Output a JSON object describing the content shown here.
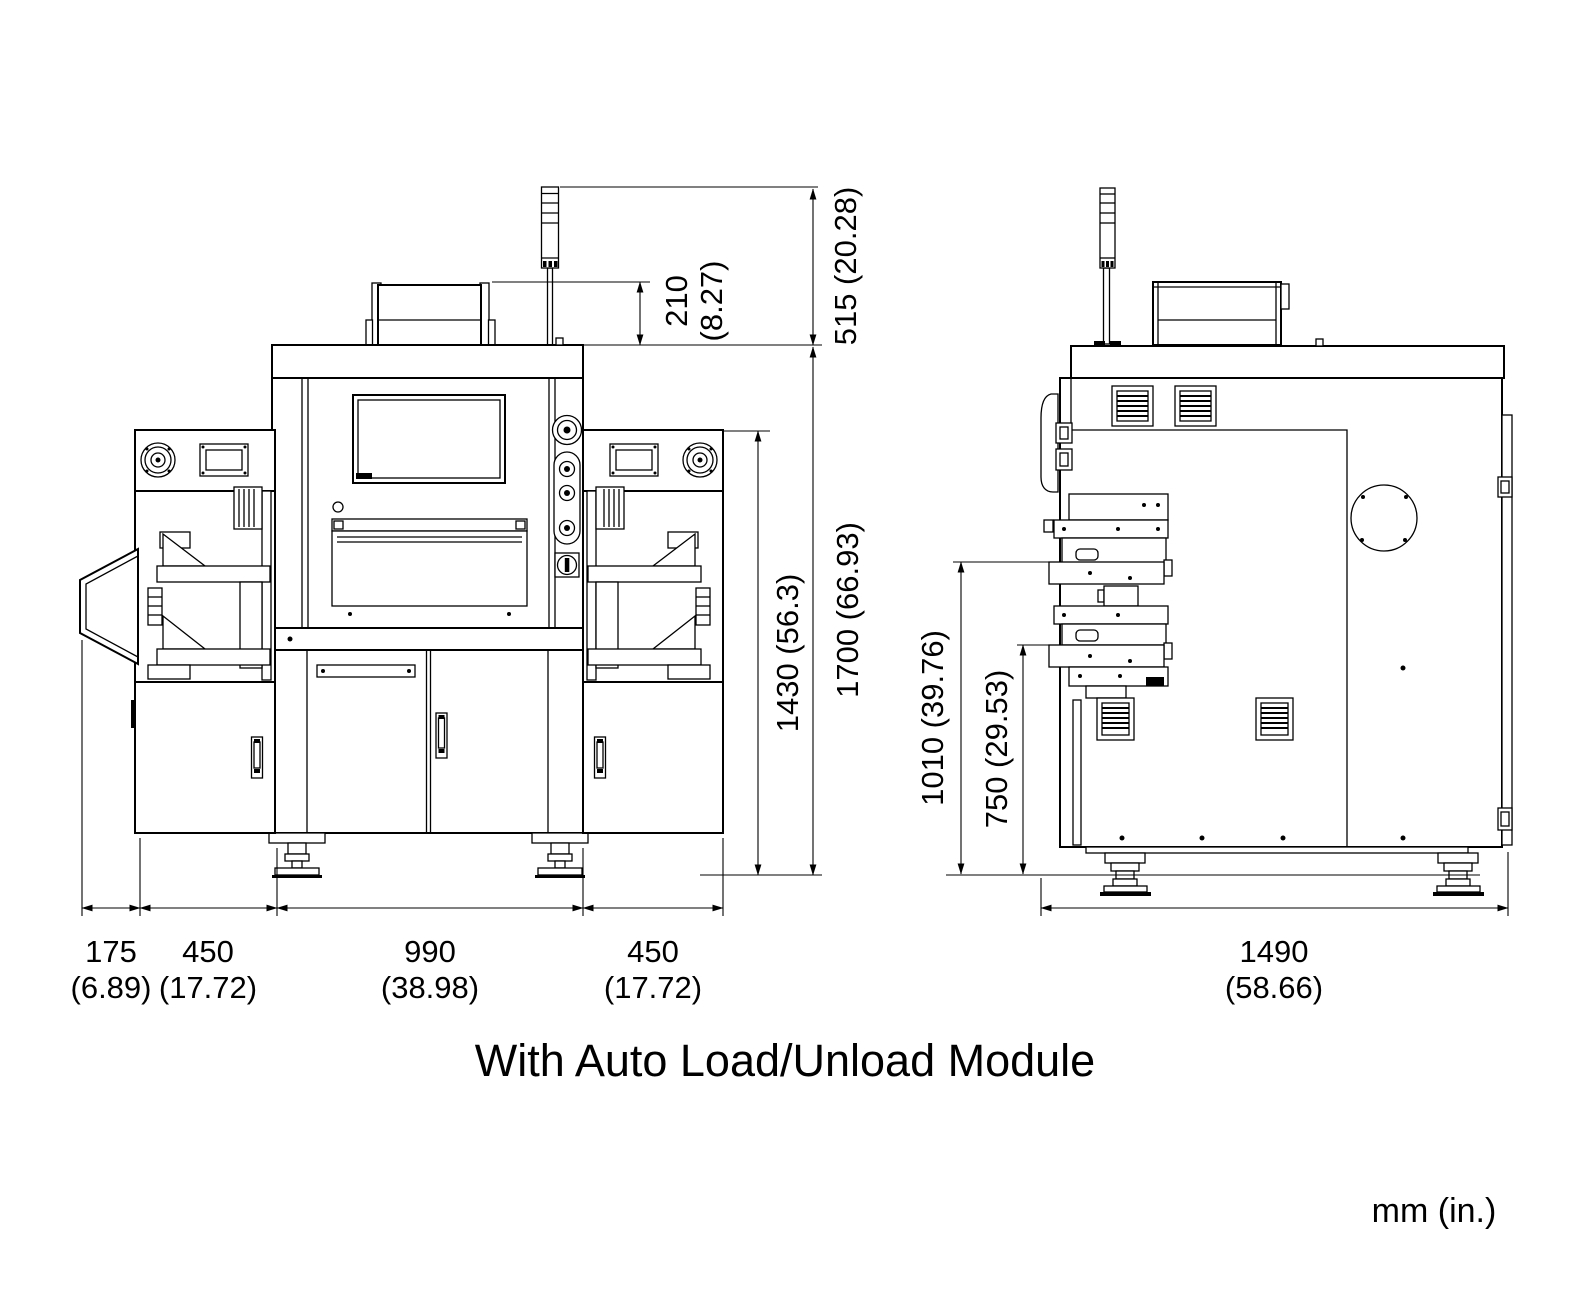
{
  "caption": "With Auto Load/Unload Module",
  "units_label": "mm (in.)",
  "colors": {
    "line": "#000000",
    "background": "#ffffff"
  },
  "dimensions": {
    "front": {
      "beacon_height": "515 (20.28)",
      "roof_box_height_mm": "210",
      "roof_box_height_in": "(8.27)",
      "total_height": "1700 (66.93)",
      "module_height": "1430 (56.3)",
      "chute_width_mm": "175",
      "chute_width_in": "(6.89)",
      "left_module_width_mm": "450",
      "left_module_width_in": "(17.72)",
      "center_width_mm": "990",
      "center_width_in": "(38.98)",
      "right_module_width_mm": "450",
      "right_module_width_in": "(17.72)"
    },
    "side": {
      "upper_conveyor_height": "1010 (39.76)",
      "lower_conveyor_height": "750 (29.53)",
      "depth_mm": "1490",
      "depth_in": "(58.66)"
    }
  }
}
